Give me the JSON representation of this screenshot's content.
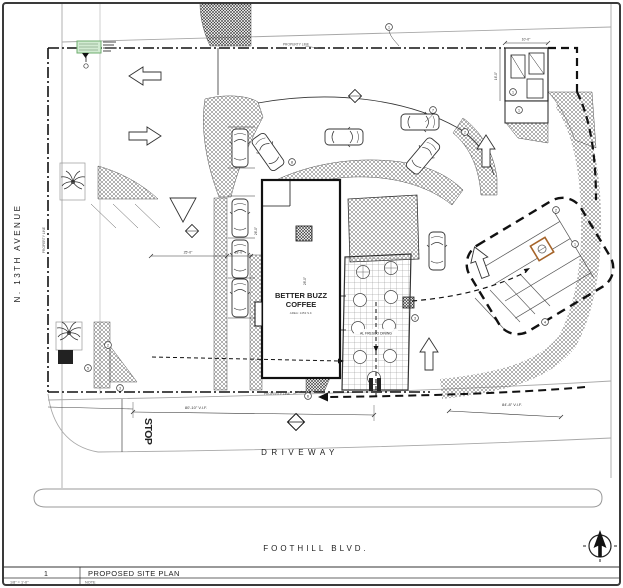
{
  "sheet": {
    "number": "1",
    "title": "PROPOSED SITE PLAN",
    "scale": "1/8\" = 1'-0\"",
    "note": "NOTE"
  },
  "streets": {
    "left_avenue": "N. 13TH AVENUE",
    "driveway": "DRIVEWAY",
    "boulevard": "FOOTHILL BLVD."
  },
  "building": {
    "name_line1": "BETTER BUZZ",
    "name_line2": "COFFEE",
    "area": "AREA: 1453 S.F."
  },
  "patio": {
    "label": "AL FRESCO DINING"
  },
  "pavement": {
    "stop": "STOP"
  },
  "property_line_label": "PROPERTY LINE",
  "dimensions": {
    "bottom_left": "80'-10\" V.I.F.",
    "bottom_right": "84'-8\" V.I.F.",
    "aisle": "25'-0\"",
    "stall": "18'-0\"",
    "drive": "26'-0\"",
    "building_width": "28'-0\"",
    "enclosure_width": "10'-0\"",
    "enclosure_depth": "16'-0\""
  },
  "keynotes": [
    "1",
    "1",
    "1",
    "7",
    "2",
    "3",
    "4",
    "2",
    "5",
    "3",
    "6",
    "1",
    "2",
    "8"
  ],
  "colors": {
    "paper": "#ffffff",
    "ink": "#1f1f1f",
    "street_gray": "#a8a8a8",
    "highlight_green": "#d2ebd2",
    "highlight_green_border": "#6fae6f",
    "accent_orange": "#a5642a"
  }
}
